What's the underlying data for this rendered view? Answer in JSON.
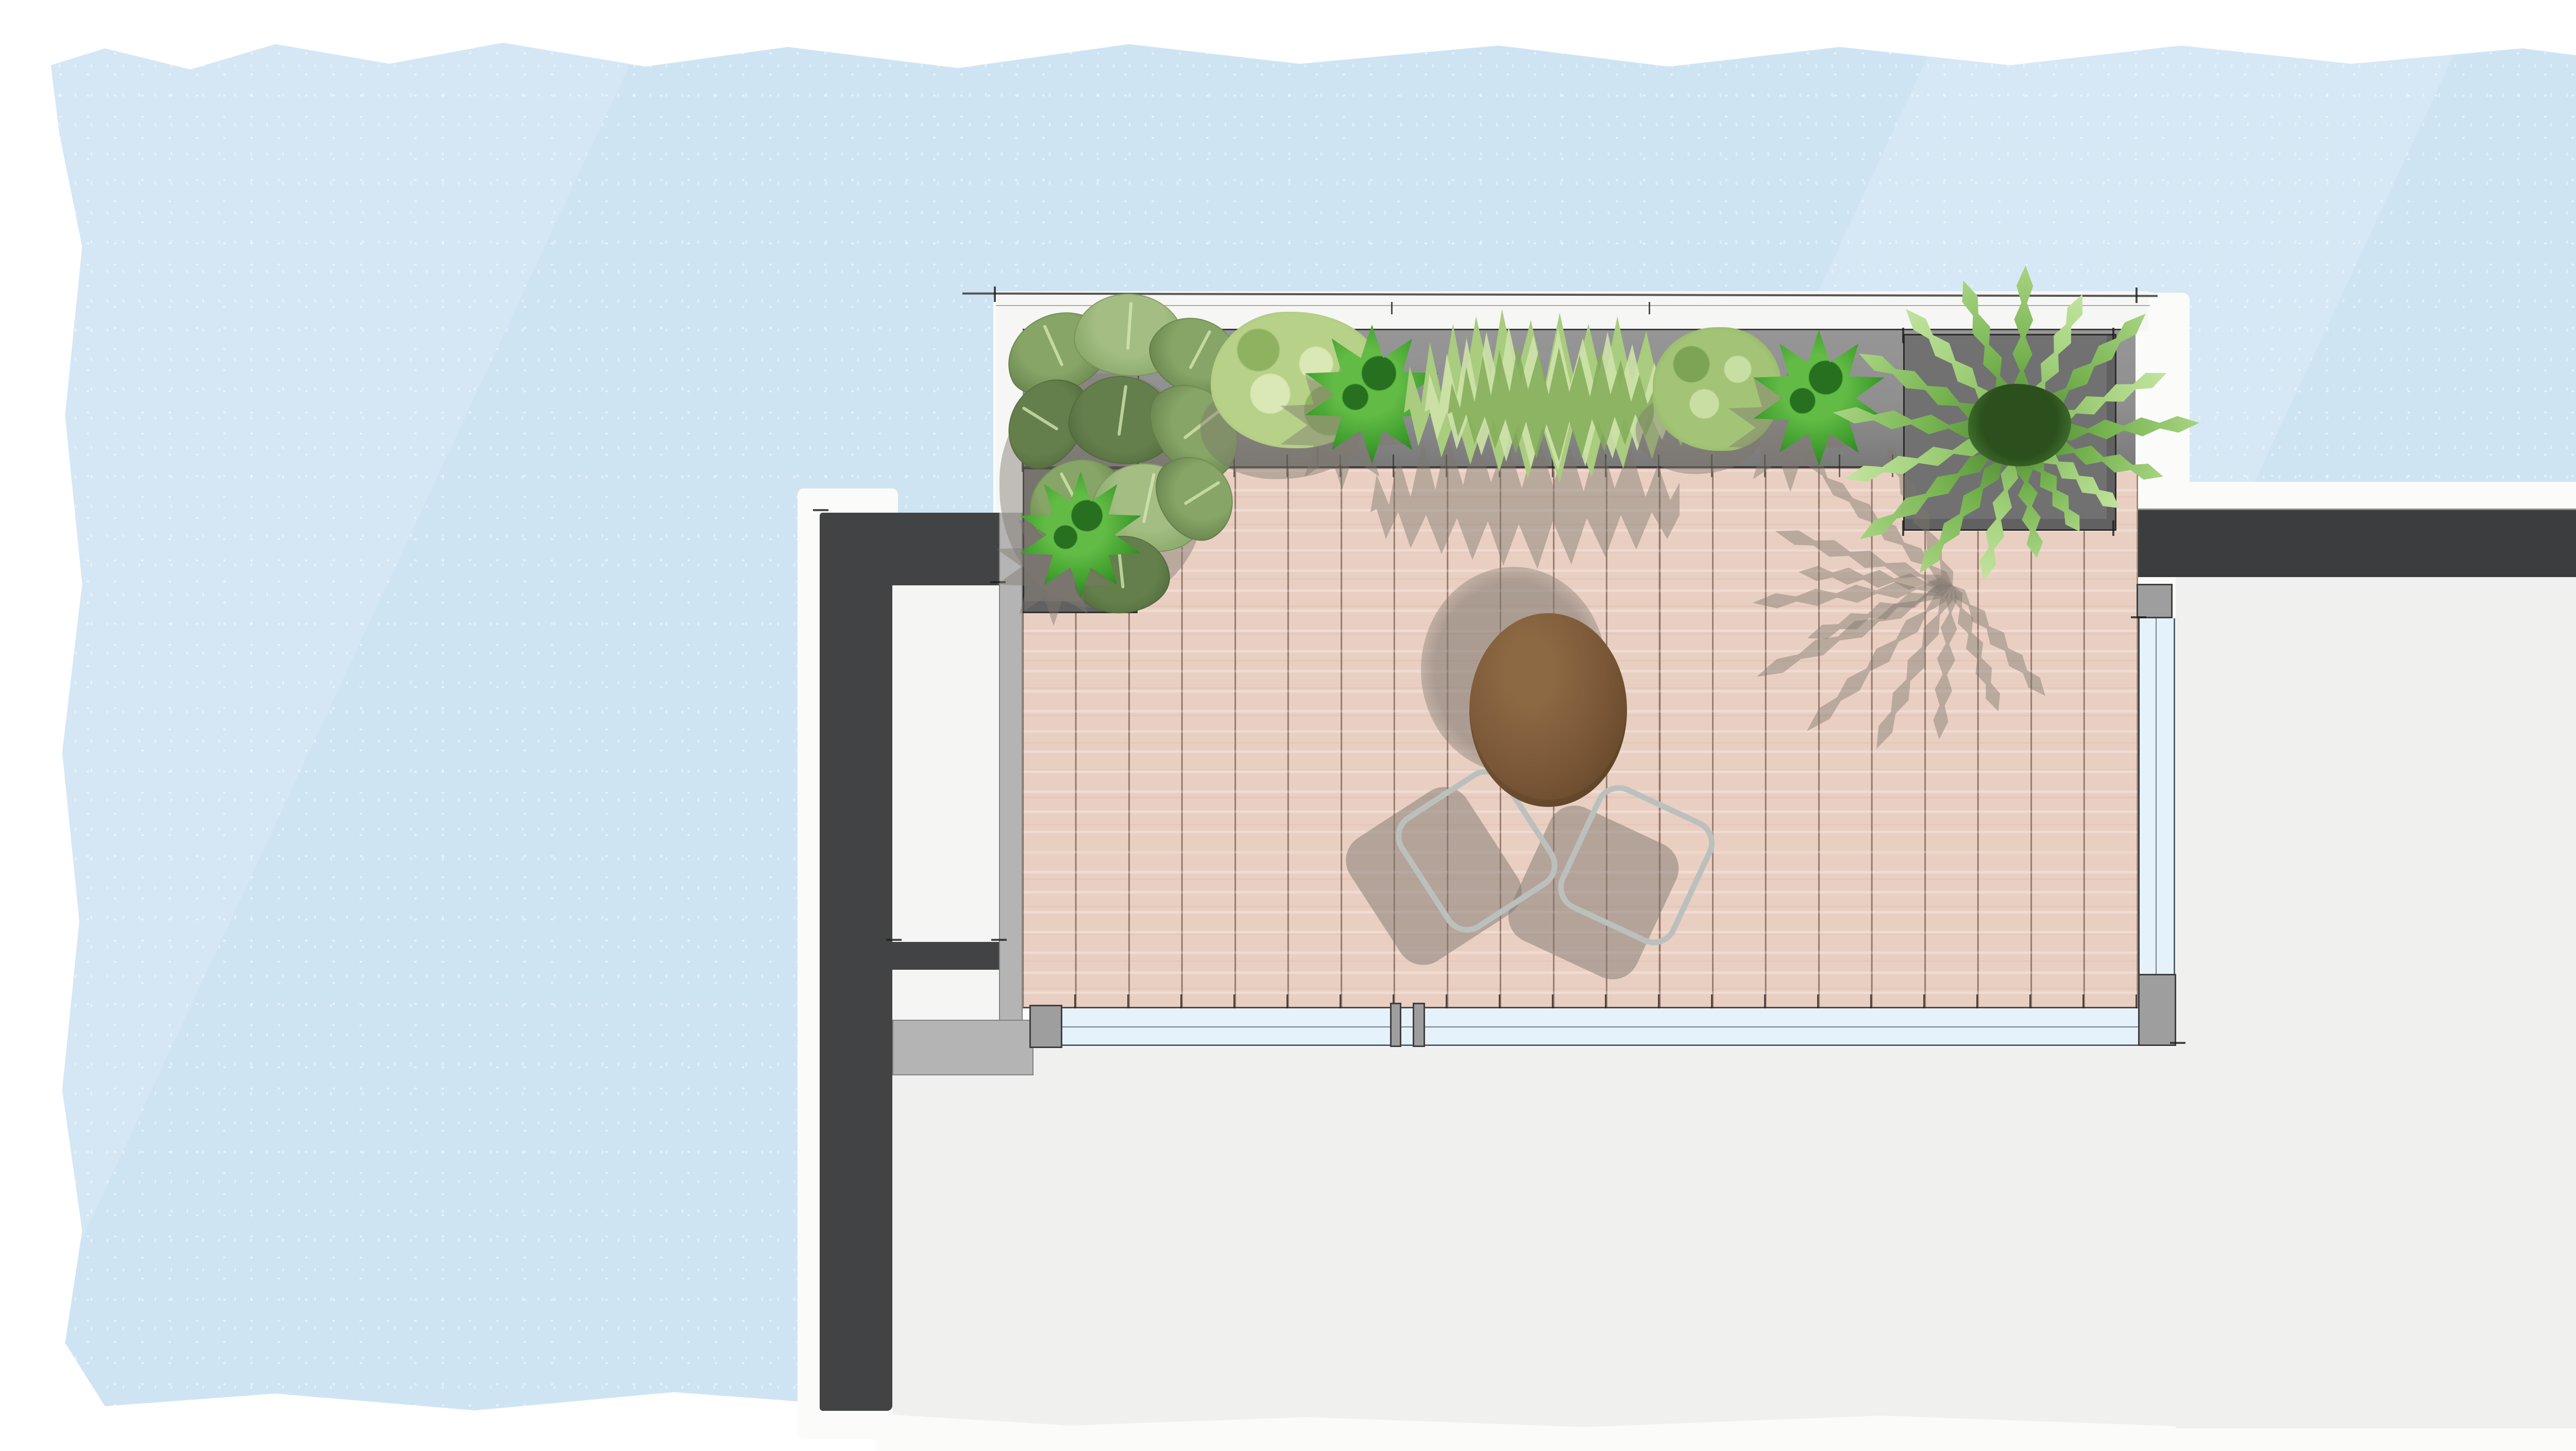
{
  "scene": {
    "description": "Hand-drawn top-view landscape plan of a roof terrace: timber deck with bistro table and two slatted chairs, a grey planter strip along the top filled with plants, a large palm in a square planter, glass balustrades, and dark charcoal building walls on a light-blue watercolor background.",
    "style": "architectural sketch / watercolor plan rendering",
    "text_content": "none (the drawing contains no visible text, numbers or labels)"
  },
  "palette": {
    "page": "#ffffff",
    "wash": "#cfe4f3",
    "halo": "#fbfbf9",
    "charcoal": "#414344",
    "band": "#3b3d3e",
    "gray_wall": "#b4b4b4",
    "gray_post": "#9e9e9e",
    "planter": "#8f8f8f",
    "planter_box": "#717171",
    "room": "#f0f0ee",
    "niche": "#f5f5f3",
    "deck": "#e9cfc2",
    "deck_line": "rgba(92,62,48,0.6)",
    "glass": "#e6f2fb",
    "glass_line": "#4e626c",
    "pencil": "#3a3a3a",
    "table": "#7a5737",
    "table_dark": "#5f4427",
    "table_light": "#8c6843",
    "chair_frame": "#bcc0bd",
    "chair_slat": "#7e6041",
    "shadow": "rgba(128,120,112,0.5)",
    "shadow_soft": "rgba(126,120,111,0.45)",
    "leaf_light": "#a3bd83",
    "leaf_mid": "#86a566",
    "leaf_dark": "#647f4b",
    "leaf_vein": "#d8e9b6",
    "shrub_base": "#b7d189",
    "shrub_light": "#d9e8b4",
    "shrub_dark": "#8fb261",
    "shrub2_base": "#a3c476",
    "shrub2_light": "#c8dea2",
    "shrub2_dark": "#7da355",
    "spiky_bright": "#62bb45",
    "spiky_mid": "#3f9e2d",
    "spiky_dark": "#267020",
    "grass_base": "#a9cc7e",
    "grass_light": "#cde2a8",
    "grass_dark": "#82ab58",
    "palm_light": "#a8d482",
    "palm_mid": "#74b14e",
    "palm_dark": "#477f31",
    "palm_core": "#2c501d"
  },
  "inventory": {
    "deck_planks": 21,
    "railing_posts": 4,
    "chairs": 2,
    "tables": 1,
    "planter_boxes": 3,
    "plants": [
      {
        "name": "large-leaf alocasia cluster",
        "location": "top-left planter corner"
      },
      {
        "name": "round watercolor shrub",
        "location": "top planter, left of centre"
      },
      {
        "name": "star-shaped fountain plant",
        "location": "top planter, centre-left"
      },
      {
        "name": "ornamental grass clump",
        "location": "top planter, centre"
      },
      {
        "name": "round watercolor shrub (dark)",
        "location": "top planter, centre-right"
      },
      {
        "name": "star-shaped fountain plant",
        "location": "top planter, right"
      },
      {
        "name": "palm / fern in square planter",
        "location": "top-right planter box"
      },
      {
        "name": "star-shaped fountain plant",
        "location": "left drop-down planter box"
      }
    ]
  }
}
